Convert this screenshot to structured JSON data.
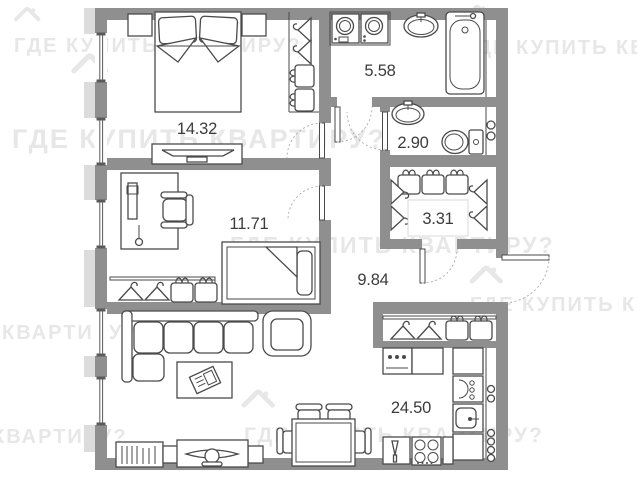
{
  "watermark": {
    "text": "ГДЕ КУПИТЬ КВАРТИРУ?",
    "color": "#e7e7e7"
  },
  "rooms": [
    {
      "id": "bedroom",
      "area_label": "14.32"
    },
    {
      "id": "bathroom",
      "area_label": "5.58"
    },
    {
      "id": "wc",
      "area_label": "2.90"
    },
    {
      "id": "closet",
      "area_label": "3.31"
    },
    {
      "id": "office",
      "area_label": "11.71"
    },
    {
      "id": "hallway",
      "area_label": "9.84"
    },
    {
      "id": "living-kitchen",
      "area_label": "24.50"
    }
  ],
  "colors": {
    "wall": "#8f8f8f",
    "furniture_outline": "#4a4a4a",
    "pilaster": "#dcdcdc",
    "label": "#3c3c3c",
    "watermark": "#e7e7e7",
    "background": "#ffffff"
  }
}
